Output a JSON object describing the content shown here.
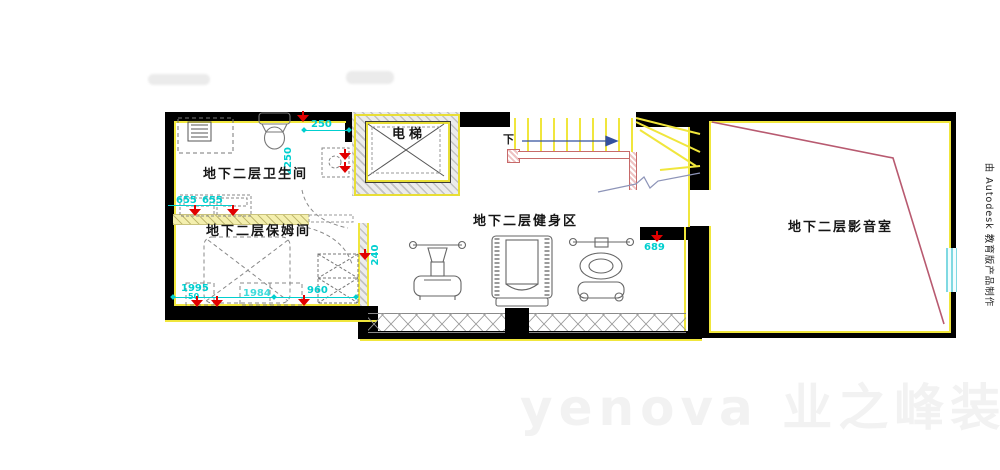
{
  "watermarks": {
    "autodesk": "由 Autodesk 教育版产品制作",
    "brand_en": "yenova",
    "brand_cn": "业之峰装饰"
  },
  "rooms": {
    "bathroom": "地下二层卫生间",
    "nanny": "地下二层保姆间",
    "gym": "地下二层健身区",
    "media": "地下二层影音室",
    "elevator": "电梯"
  },
  "stairs": {
    "down": "下"
  },
  "dims": {
    "a250": "250",
    "a2250": "2250",
    "a655l": "655",
    "a655r": "655",
    "a1995": "1995",
    "a50": "50",
    "a1984": "1984",
    "a960": "960",
    "a240": "240",
    "a689": "689"
  },
  "colors": {
    "wall": "#000000",
    "lining": "#f0e63c",
    "hatch_gray": "#c2c2c2",
    "dimension": "#00cfcf",
    "lamp_red": "#e10000",
    "handrail": "#c76a6a",
    "media_outline": "#b85a70",
    "arrow_blue": "#33509e",
    "window_cyan": "#7fd9e2"
  }
}
